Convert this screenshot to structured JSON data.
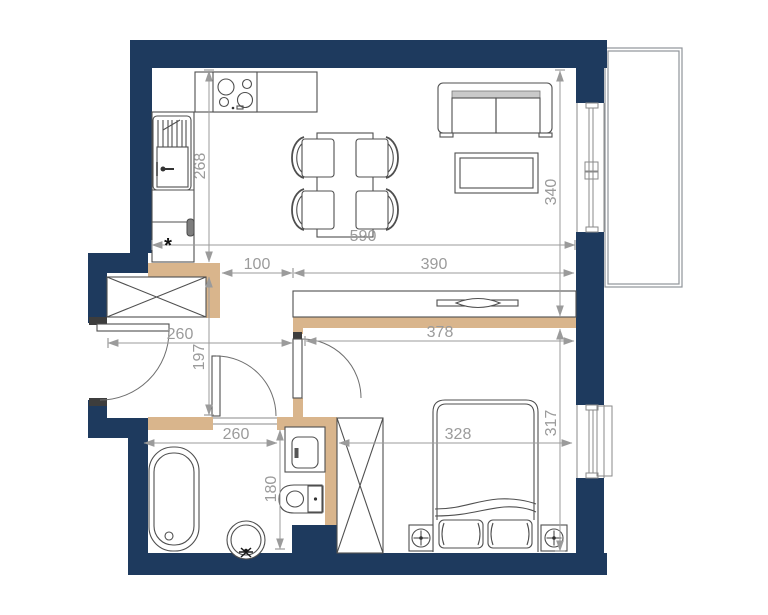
{
  "plan": {
    "colors": {
      "wall": "#1e3a5e",
      "partition": "#d9b58c",
      "furniture": "#4f4f4f",
      "dim": "#9b9b9b"
    },
    "dimensions": {
      "kitchen_wall_height": "268",
      "top_span_width": "590",
      "living_height": "340",
      "kitchen_passage": "100",
      "living_width": "390",
      "hallway_width": "260",
      "hallway_height": "197",
      "bedroom_top_width": "378",
      "bathroom_width": "260",
      "bathroom_height": "180",
      "bed_zone_width": "328",
      "bedroom_height": "317",
      "entrance_marker": "*"
    }
  }
}
